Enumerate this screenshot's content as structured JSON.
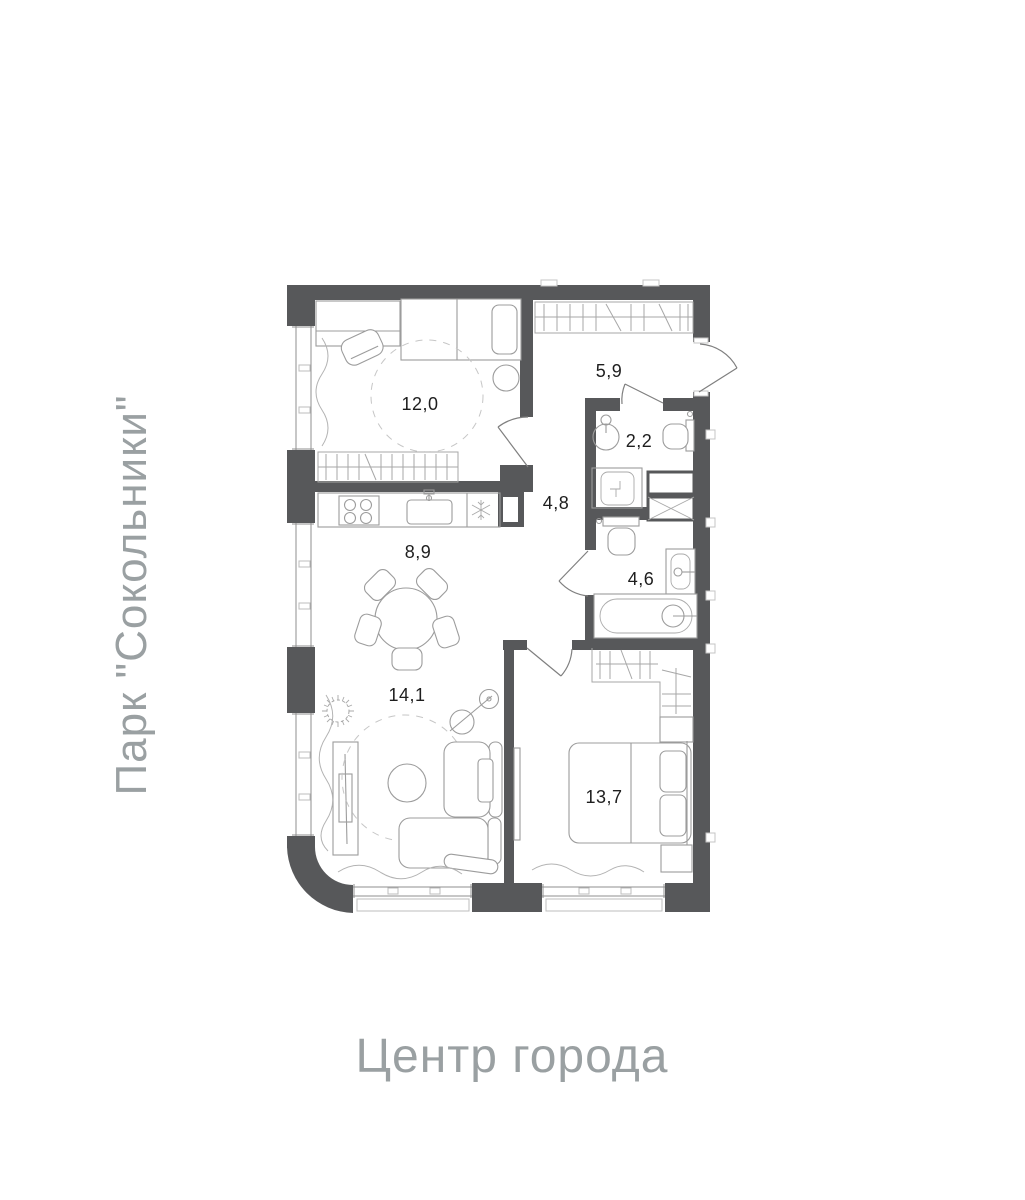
{
  "floor_plan": {
    "background": "#ffffff",
    "wall_color": "#57585a",
    "furniture_line_color": "#9c9c9c",
    "label_color": "#1e1e1e",
    "annotation_color": "#9aa0a2",
    "rooms": [
      {
        "id": "bedroom-top",
        "area": "12,0"
      },
      {
        "id": "hallway",
        "area": "5,9"
      },
      {
        "id": "wc-guest",
        "area": "2,2"
      },
      {
        "id": "corridor",
        "area": "4,8"
      },
      {
        "id": "bathroom",
        "area": "4,6"
      },
      {
        "id": "kitchen-dining",
        "area": "8,9"
      },
      {
        "id": "living-room",
        "area": "14,1"
      },
      {
        "id": "bedroom-master",
        "area": "13,7"
      }
    ],
    "annotations": {
      "left": "Парк \"Сокольники\"",
      "bottom": "Центр города"
    }
  }
}
